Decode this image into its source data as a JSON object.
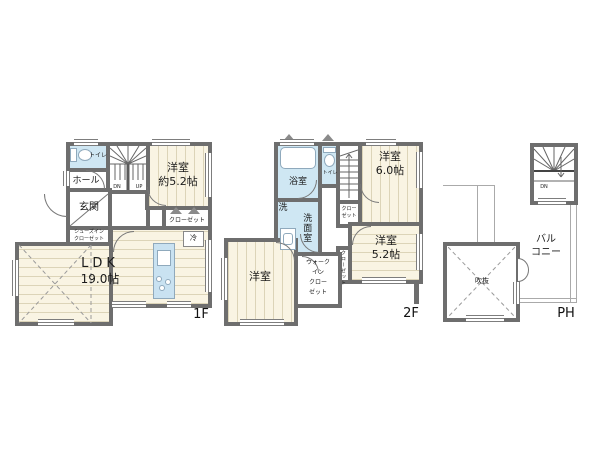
{
  "colors": {
    "wall": "#6e6e6e",
    "floor_wood": "#f9f4e3",
    "wet_area_blue": "#cfe7f3",
    "kitchen_blue": "#c9e2f1",
    "line_gray": "#888888"
  },
  "f1": {
    "tag": "1F",
    "rooms": {
      "toilet": "トイレ",
      "hall": "ホール",
      "entrance": "玄関",
      "western_1": {
        "name": "洋室",
        "size": "約5.2帖"
      },
      "closet": "クローゼット",
      "shoes_closet": {
        "line1": "シューズイン",
        "line2": "クローゼット"
      },
      "ldk": {
        "name": "LDK",
        "size": "19.0帖"
      }
    },
    "fixtures": {
      "fridge": "冷"
    },
    "stairs": {
      "down": "DN",
      "up": "UP"
    }
  },
  "f2": {
    "tag": "2F",
    "rooms": {
      "bath": "浴室",
      "toilet": "トイレ",
      "washroom": "洗面室",
      "washer": "洗",
      "western_6": {
        "name": "洋室",
        "size": "6.0帖"
      },
      "western_52": {
        "name": "洋室",
        "size": "5.2帖"
      },
      "western_sw": "洋室",
      "closet_a": {
        "line1": "クロー",
        "line2": "ゼット"
      },
      "closet_b": "クローゼット",
      "wic": {
        "line1": "ウォーク",
        "line2": "イン",
        "line3": "クロー",
        "line4": "ゼット"
      }
    }
  },
  "ph": {
    "tag": "PH",
    "balcony": {
      "line1": "バル",
      "line2": "コニー"
    },
    "void": "吹抜",
    "stairs": {
      "down": "DN"
    }
  }
}
